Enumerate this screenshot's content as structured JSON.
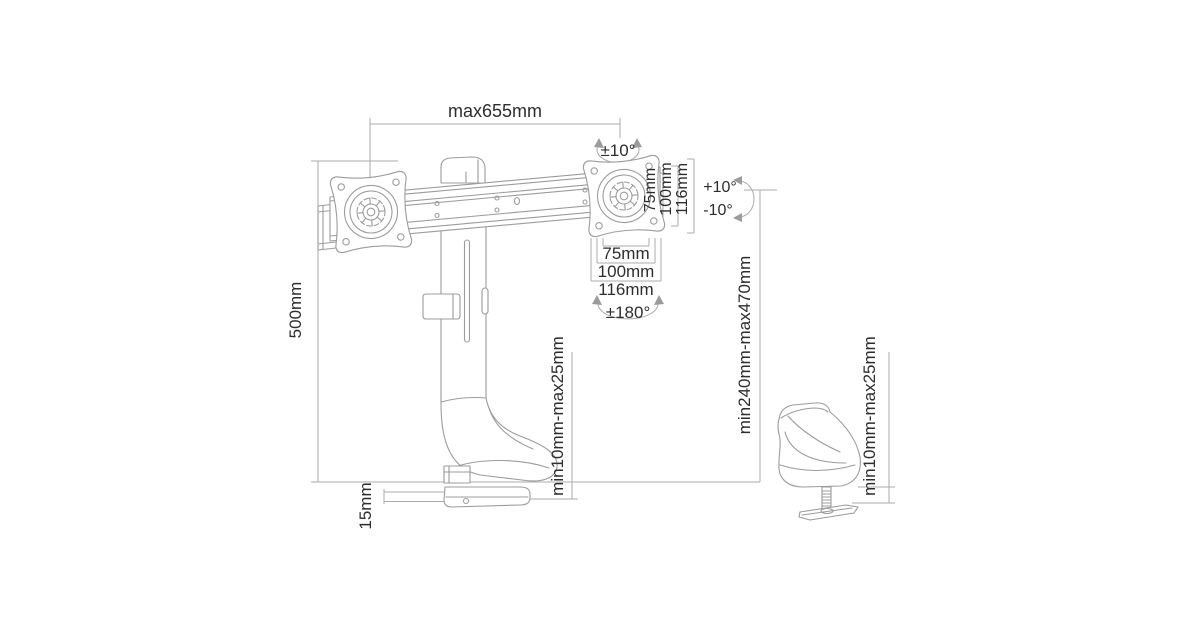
{
  "diagram": {
    "subject": "dual-monitor desk mount crossbar with height adjustable column, clamp and grommet fixing",
    "colors": {
      "background": "#ffffff",
      "drawing_line": "#9c9c9c",
      "dimension_line": "#ababab",
      "text": "#2d2d2d"
    },
    "dimensions": {
      "max_width": "max655mm",
      "swivel": "±10°",
      "tilt_up": "+10°",
      "tilt_down": "-10°",
      "rotation": "±180°",
      "vesa_vertical": [
        "75mm",
        "100mm",
        "116mm"
      ],
      "vesa_horizontal": [
        "75mm",
        "100mm",
        "116mm"
      ],
      "pole_height": "500mm",
      "clamp_desk_thickness": "min10mm-max25mm",
      "height_range": "min240mm-max470mm",
      "clamp_plate_thickness": "15mm",
      "grommet_desk_thickness": "min10mm-max25mm"
    }
  }
}
